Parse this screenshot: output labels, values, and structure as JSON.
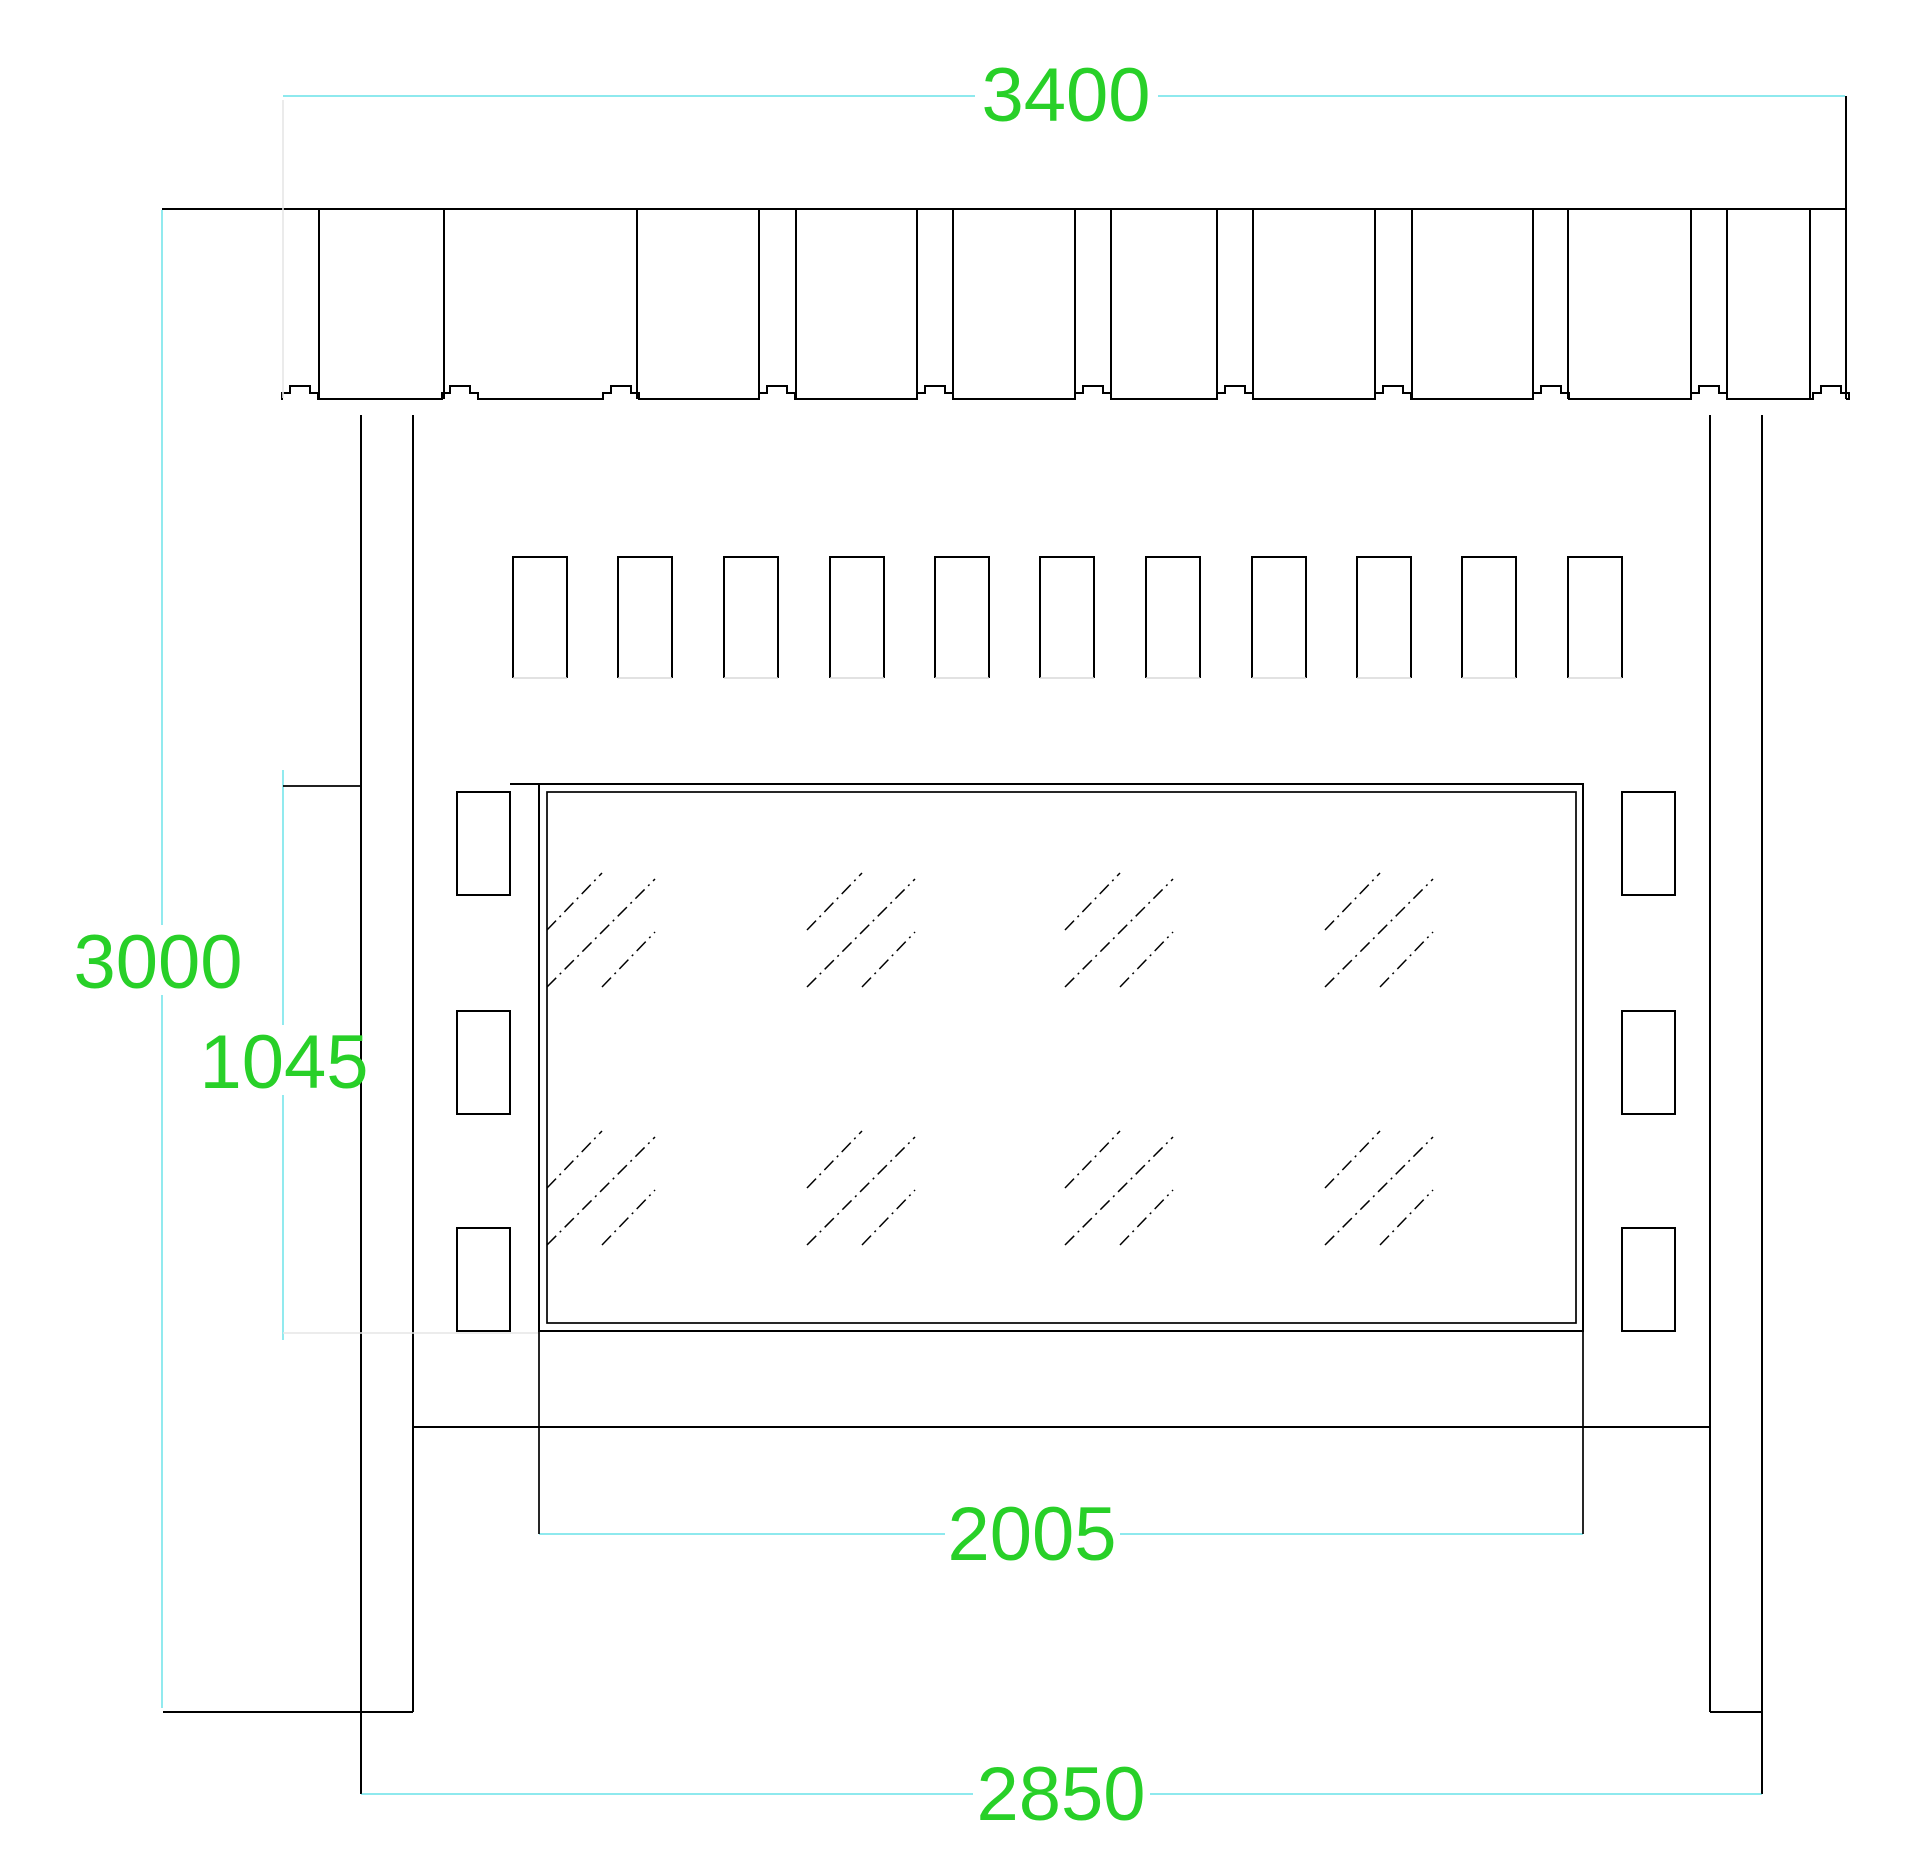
{
  "drawing": {
    "dimension_labels": {
      "roof_width": "3400",
      "overall_height": "3000",
      "glazing_height": "1045",
      "glazing_width": "2005",
      "frame_width": "2850"
    },
    "colors": {
      "dimension_text": "#28d028",
      "dimension_line": "#7ee6ec",
      "object_line": "#000000",
      "faint_line": "#e6e6e6",
      "background": "#ffffff"
    }
  }
}
